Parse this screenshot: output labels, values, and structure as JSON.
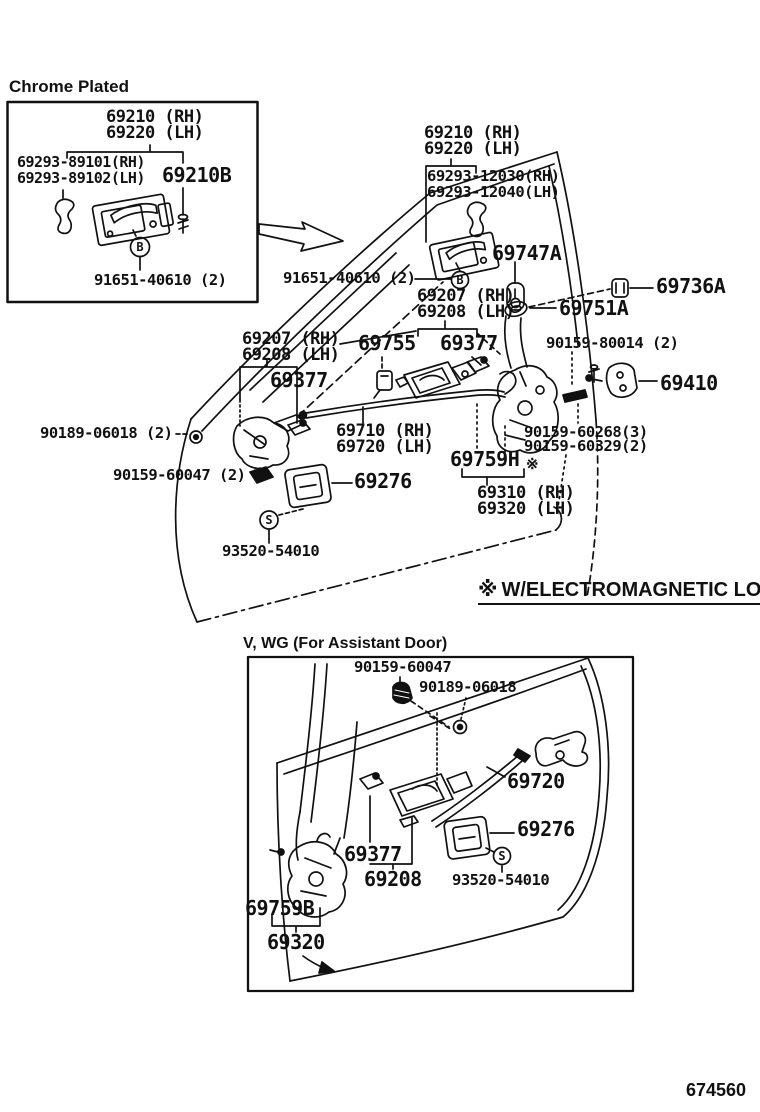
{
  "doc": {
    "page_code": "674560",
    "note_symbol": "※",
    "note_text": "W/ELECTROMAGNETIC LOCK"
  },
  "chrome_box": {
    "title": "Chrome Plated",
    "l_69210": "69210 (RH)",
    "l_69220": "69220 (LH)",
    "l_69293_rh": "69293-89101(RH)",
    "l_69293_lh": "69293-89102(LH)",
    "l_69210b": "69210B",
    "l_91651": "91651-40610 (2)",
    "marker_b": "B"
  },
  "main": {
    "l_69210": "69210 (RH)",
    "l_69220": "69220 (LH)",
    "l_69293_rh": "69293-12030(RH)",
    "l_69293_lh": "69293-12040(LH)",
    "l_69747a": "69747A",
    "l_91651": "91651-40610 (2)",
    "l_69736a": "69736A",
    "l_69207_u": "69207 (RH)",
    "l_69208_u": "69208 (LH)",
    "l_69751a": "69751A",
    "l_69207_l": "69207 (RH)",
    "l_69208_l": "69208 (LH)",
    "l_69755": "69755",
    "l_69377_c": "69377",
    "l_90159_80014": "90159-80014 (2)",
    "l_69377_l": "69377",
    "l_69410": "69410",
    "l_90189": "90189-06018 (2)",
    "l_69710": "69710 (RH)",
    "l_69720": "69720 (LH)",
    "l_60268": "90159-60268(3)",
    "l_60329": "90159-60329(2)",
    "l_69759h": "69759H",
    "l_69759h_star": "※",
    "l_60047": "90159-60047 (2)",
    "l_69276": "69276",
    "l_69310": "69310 (RH)",
    "l_69320": "69320 (LH)",
    "l_93520": "93520-54010",
    "marker_b": "B",
    "marker_s": "S"
  },
  "assistant_box": {
    "title": "V, WG (For Assistant Door)",
    "l_60047": "90159-60047",
    "l_90189": "90189-06018",
    "l_69720": "69720",
    "l_69276": "69276",
    "l_69377": "69377",
    "l_69208": "69208",
    "l_93520": "93520-54010",
    "l_69759b": "69759B",
    "l_69320": "69320",
    "marker_s": "S"
  }
}
